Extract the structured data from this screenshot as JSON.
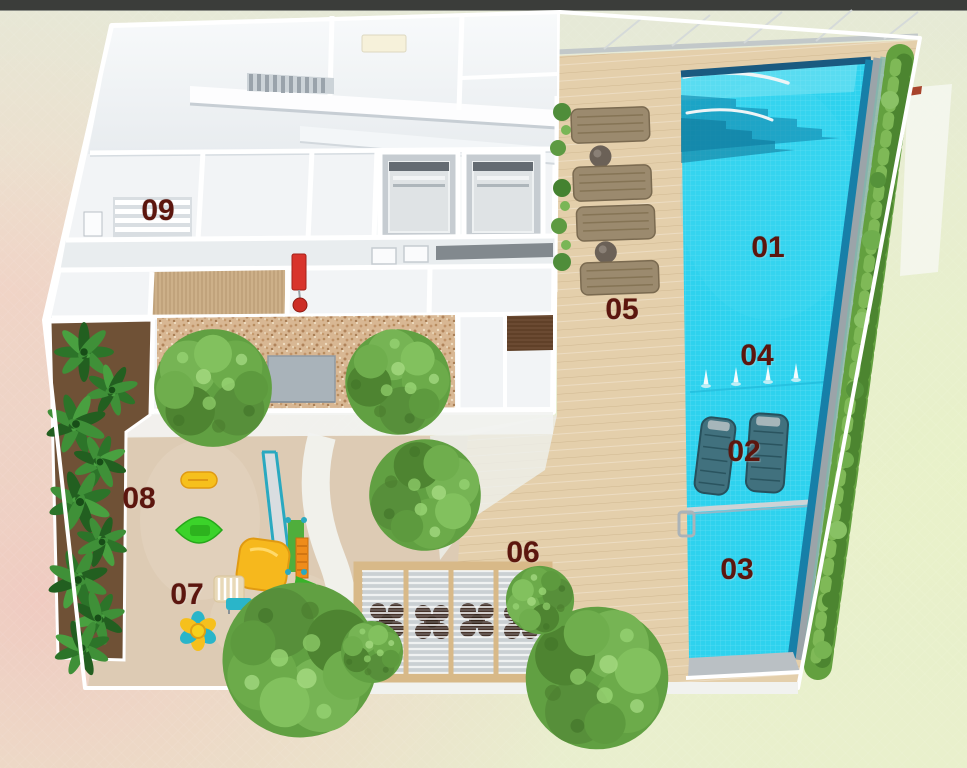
{
  "plan": {
    "kind": "3d-floorplan-rendering",
    "labels": [
      {
        "text": "01"
      },
      {
        "text": "02"
      },
      {
        "text": "03"
      },
      {
        "text": "04"
      },
      {
        "text": "05"
      },
      {
        "text": "06"
      },
      {
        "text": "07"
      },
      {
        "text": "08"
      },
      {
        "text": "09"
      }
    ],
    "palette": {
      "top_bar": "#3b3d3a",
      "label_text": "#5c160e",
      "pool_water": "#2ed2ee",
      "pool_edge_dark": "#1a5a80",
      "deck_wood": "#e4cfab",
      "sand": "#ddcbb4",
      "gravel": "#d8b793",
      "hedge_green": "#63a03f",
      "tree_green": "#61a042",
      "pergola_wood": "#d8b988",
      "play_yellow": "#f6c01d",
      "play_green": "#3bd32a",
      "play_teal": "#2aa9c0",
      "hydrant_red": "#d8342c",
      "background_pink": "#f0c9c0",
      "background_green": "#e9f3c6",
      "wall_white": "#ffffff"
    }
  }
}
